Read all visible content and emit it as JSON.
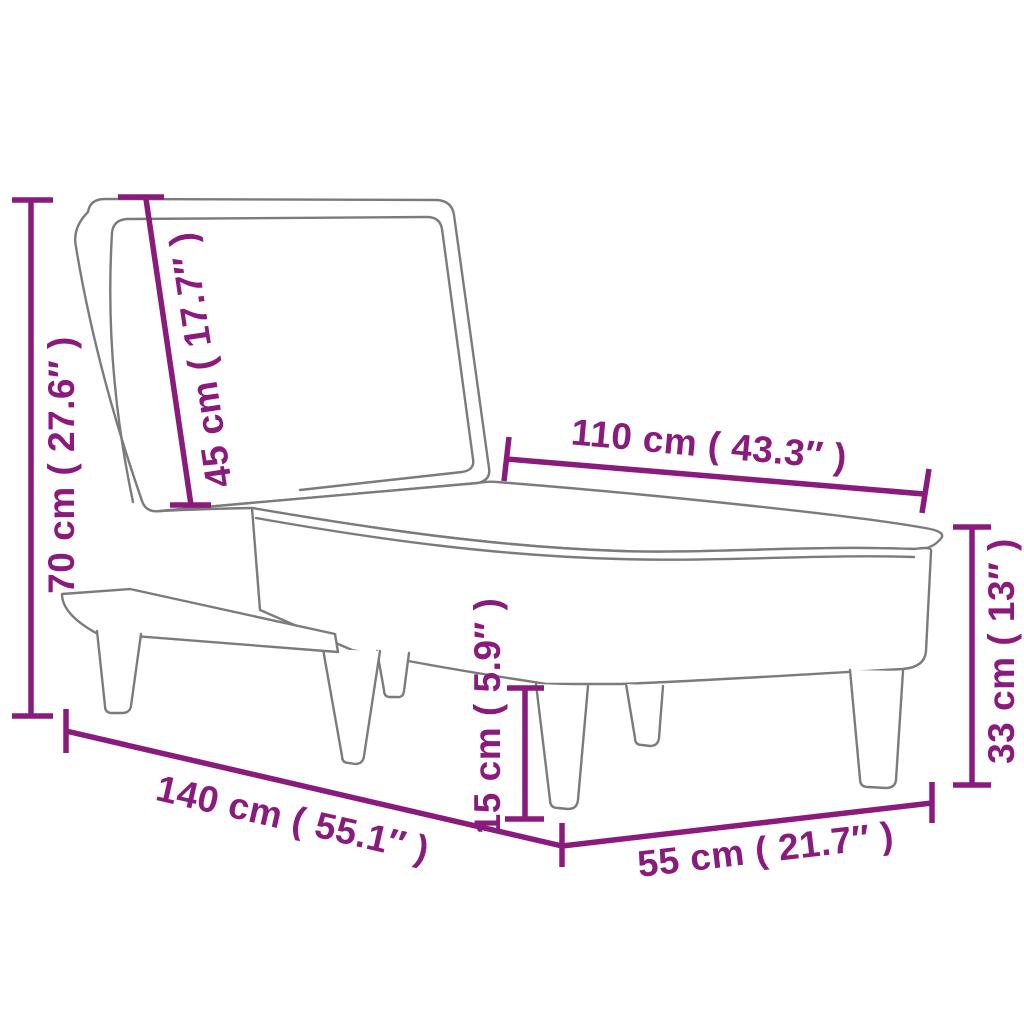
{
  "colors": {
    "background": "#ffffff",
    "line_art": "#7b7b7b",
    "dimension_accent": "#8B1A7D"
  },
  "diagram": {
    "product": "chaise-longue-dimension-drawing",
    "dimensions": [
      {
        "id": "total-height",
        "label": "70 cm ( 27.6″ )"
      },
      {
        "id": "backrest-length",
        "label": "45 cm ( 17.7″ )"
      },
      {
        "id": "seat-length",
        "label": "110 cm ( 43.3″ )"
      },
      {
        "id": "seat-height",
        "label": "33 cm ( 13″ )"
      },
      {
        "id": "leg-height",
        "label": "15 cm ( 5.9″ )"
      },
      {
        "id": "total-length",
        "label": "140 cm ( 55.1″ )"
      },
      {
        "id": "total-width",
        "label": "55 cm ( 21.7″ )"
      }
    ]
  }
}
